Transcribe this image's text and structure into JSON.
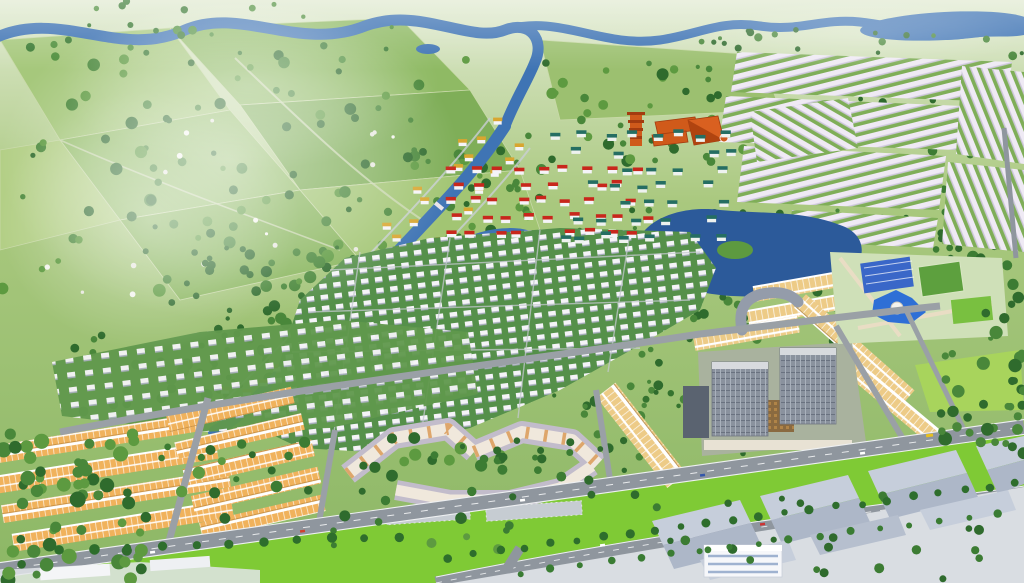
{
  "image": {
    "kind": "3d-aerial-masterplan-rendering",
    "width": 1024,
    "height": 583,
    "visible_text": "none"
  },
  "palette": {
    "haze": "#ffffff",
    "field_light": "#b3cf86",
    "field_mid": "#7fae58",
    "field_soft": "#a6c87c",
    "field_deep": "#8fba64",
    "lawn": "#7fca35",
    "meadow": "#a8d45c",
    "tree_dark": "#2f6b2d",
    "tree_mid": "#49873a",
    "tree_light": "#5d9a40",
    "water": "#3f74b4",
    "water_deep": "#2c5a9a",
    "road": "#8f969e",
    "road_edge": "#eef0f2",
    "street": "#c9ced4",
    "townhouse_roof": "#efeaf4",
    "townhouse_shadow": "#cfc7de",
    "shophouse_roof": "#f0b25c",
    "shophouse_roof_gold": "#edcb87",
    "shophouse_ridge": "#ffffff",
    "red_roof": "#c8271c",
    "teal_roof": "#256e62",
    "gold_roof": "#d8a630",
    "villa_white": "#f5f4f8",
    "villa_shadow": "#a7adbd",
    "temple_orange": "#cf5a1b",
    "temple_dark": "#a33c10",
    "apartment_wall": "#f0e8dc",
    "apartment_accent": "#dc9e5e",
    "apartment_roof": "#c2bccb",
    "tower_glass": "#8a929e",
    "tower_glass_light": "#a9b1bc",
    "tower_dark": "#5a6370",
    "podium": "#a9b29e",
    "courtyard": "#8a6a40",
    "clubhouse_roof": "#3a67c8",
    "pool": "#2e6fd6",
    "plaza": "#e9ddc4",
    "warehouse_roof_light": "#c6cedb",
    "warehouse_roof_dark": "#adb7c8",
    "warehouse_wall": "#f6f7fa",
    "concrete": "#d9dde2",
    "bus_yellow": "#e8c020"
  },
  "scene": {
    "regions": [
      {
        "name": "countryside-farmland"
      },
      {
        "name": "river-network"
      },
      {
        "name": "townhouse-district"
      },
      {
        "name": "temple-complex"
      },
      {
        "name": "red-roof-villa-cluster"
      },
      {
        "name": "teal-roof-villa-cluster"
      },
      {
        "name": "gold-roof-river-corridor"
      },
      {
        "name": "white-villa-field"
      },
      {
        "name": "shophouse-clusters"
      },
      {
        "name": "apartment-complex"
      },
      {
        "name": "office-complex"
      },
      {
        "name": "amenity-center"
      },
      {
        "name": "central-lake"
      },
      {
        "name": "arterial-roads"
      },
      {
        "name": "industrial-park"
      }
    ]
  },
  "generated": {
    "villa_grids": [
      {
        "name": "red-roof-villas",
        "x": 446,
        "y": 166,
        "cols": 9,
        "rows": 5,
        "dx": 23,
        "dy": 16,
        "stagger": 10,
        "jitter": 5,
        "w": 9,
        "roof": "#c8271c",
        "wall": "#f5f4f8",
        "keep": 0.8,
        "seed": 11
      },
      {
        "name": "teal-roof-villas",
        "x": 556,
        "y": 132,
        "cols": 8,
        "rows": 7,
        "dx": 23,
        "dy": 17,
        "stagger": 12,
        "jitter": 6,
        "w": 9,
        "roof": "#256e62",
        "wall": "#eef2ef",
        "keep": 0.7,
        "seed": 23
      }
    ],
    "river_villas": {
      "name": "gold-roof-villas",
      "points": [
        [
          505,
          128
        ],
        [
          478,
          160
        ],
        [
          450,
          194
        ],
        [
          421,
          226
        ],
        [
          392,
          257
        ],
        [
          363,
          288
        ],
        [
          335,
          317
        ],
        [
          308,
          345
        ],
        [
          281,
          373
        ],
        [
          256,
          399
        ],
        [
          232,
          423
        ]
      ],
      "offsets": [
        {
          "o": -18,
          "k": 0.9
        },
        {
          "o": 15,
          "k": 0.9
        },
        {
          "o": 29,
          "k": 0.45
        }
      ],
      "w": 8,
      "roof": "#d8a630",
      "wall": "#f5f4f8",
      "jitter": 4,
      "seed": 7
    },
    "tree_bands": [
      {
        "layer": "trees-far",
        "x": 0,
        "y": 55,
        "w": 540,
        "h": 240,
        "count": 95,
        "rmin": 2.5,
        "rmax": 6.5,
        "seed": 101,
        "colors": [
          "#2f6b2d",
          "#49873a",
          "#5d9a40"
        ]
      },
      {
        "layer": "trees-far",
        "x": 540,
        "y": 60,
        "w": 250,
        "h": 110,
        "count": 45,
        "rmin": 2.5,
        "rmax": 6,
        "seed": 102,
        "colors": [
          "#2f6b2d",
          "#49873a",
          "#5d9a40"
        ]
      },
      {
        "layer": "trees-far",
        "x": 160,
        "y": 230,
        "w": 260,
        "h": 190,
        "count": 55,
        "rmin": 3,
        "rmax": 6.5,
        "seed": 103,
        "colors": [
          "#2f6b2d",
          "#49873a"
        ]
      },
      {
        "layer": "trees-far",
        "x": 380,
        "y": 150,
        "w": 180,
        "h": 110,
        "count": 35,
        "rmin": 2.5,
        "rmax": 5.5,
        "seed": 104,
        "colors": [
          "#2f6b2d",
          "#49873a",
          "#5d9a40"
        ]
      },
      {
        "layer": "trees-far",
        "x": 690,
        "y": 40,
        "w": 330,
        "h": 230,
        "count": 38,
        "rmin": 2,
        "rmax": 4.5,
        "seed": 105,
        "colors": [
          "#2f6b2d",
          "#49873a"
        ]
      },
      {
        "layer": "trees-far",
        "x": 930,
        "y": 130,
        "w": 94,
        "h": 180,
        "count": 40,
        "rmin": 3,
        "rmax": 6,
        "seed": 106,
        "colors": [
          "#2f6b2d",
          "#3c7c33"
        ]
      },
      {
        "layer": "trees-near",
        "x": 940,
        "y": 300,
        "w": 84,
        "h": 160,
        "count": 35,
        "rmin": 3.5,
        "rmax": 7,
        "seed": 107,
        "colors": [
          "#2f6b2d",
          "#49873a"
        ]
      },
      {
        "layer": "trees-near",
        "x": 0,
        "y": 430,
        "w": 150,
        "h": 150,
        "count": 55,
        "rmin": 4,
        "rmax": 8,
        "seed": 108,
        "colors": [
          "#2f6b2d",
          "#49873a",
          "#5d9a40"
        ]
      },
      {
        "layer": "trees-far",
        "x": 280,
        "y": 230,
        "w": 420,
        "h": 200,
        "count": 45,
        "rmin": 2,
        "rmax": 4,
        "seed": 109,
        "colors": [
          "#35732f",
          "#49873a"
        ]
      },
      {
        "layer": "trees-far",
        "x": 60,
        "y": 320,
        "w": 420,
        "h": 110,
        "count": 40,
        "rmin": 2.5,
        "rmax": 5,
        "seed": 110,
        "colors": [
          "#2f6b2d",
          "#49873a"
        ]
      },
      {
        "layer": "trees-near",
        "x": 150,
        "y": 430,
        "w": 360,
        "h": 125,
        "count": 40,
        "rmin": 3,
        "rmax": 6.5,
        "seed": 111,
        "colors": [
          "#2f6b2d",
          "#3c7c33",
          "#5d9a40"
        ]
      },
      {
        "layer": "trees-far",
        "x": 540,
        "y": 300,
        "w": 300,
        "h": 160,
        "count": 45,
        "rmin": 2.5,
        "rmax": 5.5,
        "seed": 112,
        "colors": [
          "#2f6b2d",
          "#49873a"
        ]
      },
      {
        "layer": "trees-far",
        "x": 780,
        "y": 200,
        "w": 230,
        "h": 140,
        "count": 32,
        "rmin": 2.5,
        "rmax": 5,
        "seed": 113,
        "colors": [
          "#2f6b2d",
          "#49873a"
        ]
      },
      {
        "layer": "trees-far",
        "x": 0,
        "y": 0,
        "w": 400,
        "h": 60,
        "count": 25,
        "rmin": 2,
        "rmax": 5,
        "seed": 114,
        "colors": [
          "#3a7a33",
          "#4f8f3c"
        ]
      },
      {
        "layer": "trees-far",
        "x": 20,
        "y": 90,
        "w": 420,
        "h": 210,
        "count": 18,
        "rmin": 1.5,
        "rmax": 3,
        "seed": 115,
        "colors": [
          "#f4f4ef",
          "#e8e8e0"
        ]
      },
      {
        "layer": "trees-far",
        "x": 186,
        "y": 245,
        "w": 60,
        "h": 180,
        "count": 22,
        "rmin": 2,
        "rmax": 3.5,
        "seed": 116,
        "colors": [
          "#2f6b2d"
        ]
      },
      {
        "layer": "palms",
        "x": 620,
        "y": 470,
        "w": 404,
        "h": 110,
        "count": 24,
        "rmin": 3,
        "rmax": 5,
        "seed": 117,
        "colors": [
          "#2f6b2d",
          "#3c7c33"
        ]
      },
      {
        "layer": "trees-far",
        "x": 700,
        "y": 28,
        "w": 324,
        "h": 30,
        "count": 18,
        "rmin": 2,
        "rmax": 4.5,
        "seed": 118,
        "colors": [
          "#2f6b2d",
          "#49873a"
        ]
      },
      {
        "layer": "trees-far",
        "x": 620,
        "y": 195,
        "w": 180,
        "h": 110,
        "count": 25,
        "rmin": 2,
        "rmax": 4.5,
        "seed": 119,
        "colors": [
          "#2f6b2d",
          "#49873a"
        ]
      },
      {
        "layer": "trees-near",
        "x": 340,
        "y": 440,
        "w": 300,
        "h": 60,
        "count": 25,
        "rmin": 2.5,
        "rmax": 5,
        "seed": 120,
        "colors": [
          "#2f6b2d",
          "#3c7c33"
        ]
      }
    ],
    "palm_rows": [
      {
        "x1": 450,
        "y1": 568,
        "x2": 1020,
        "y2": 494,
        "offset": -11,
        "step": 26,
        "r": 4,
        "seed": 130,
        "color": "#2e6e2c"
      },
      {
        "x1": 520,
        "y1": 560,
        "x2": 1020,
        "y2": 498,
        "offset": 13,
        "step": 30,
        "r": 3.6,
        "seed": 131,
        "color": "#3a7c33"
      },
      {
        "x1": 60,
        "y1": 560,
        "x2": 430,
        "y2": 545,
        "offset": -10,
        "step": 34,
        "r": 4.5,
        "seed": 132,
        "color": "#2e6e2c"
      }
    ]
  }
}
